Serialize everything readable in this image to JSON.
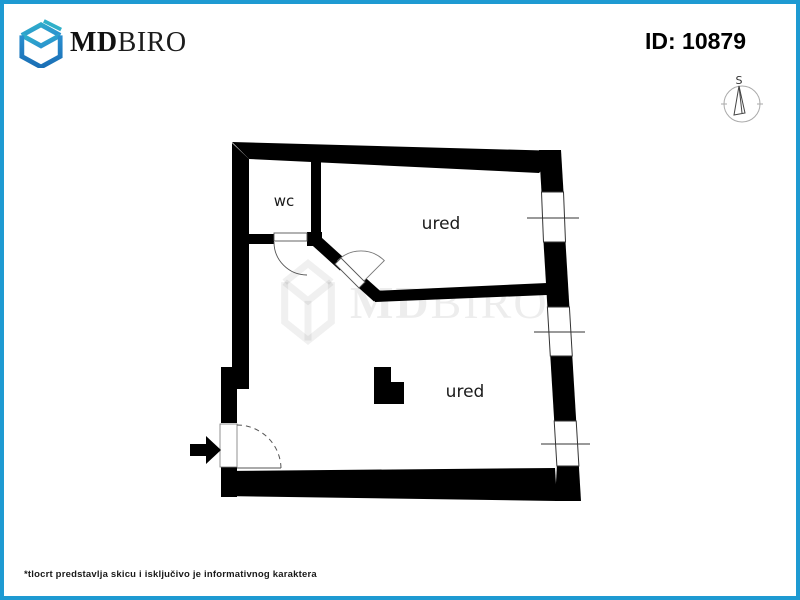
{
  "page": {
    "accent_border_color": "#1e9ad2",
    "wall_color": "#000000",
    "background_color": "#ffffff"
  },
  "header": {
    "logo": {
      "md": "MD",
      "biro": "BIRO",
      "color_top": "#2fb0c9",
      "color_bottom": "#1a6fb5"
    },
    "id_label": "ID: 10879"
  },
  "compass": {
    "north_label": "S"
  },
  "floorplan": {
    "rooms": [
      {
        "name": "wc",
        "label": "wc"
      },
      {
        "name": "ured-upper",
        "label": "ured"
      },
      {
        "name": "ured-lower",
        "label": "ured"
      }
    ]
  },
  "watermark": {
    "md": "MD",
    "biro": "BIRO"
  },
  "footer": {
    "disclaimer": "*tlocrt predstavlja skicu i isključivo je informativnog karaktera"
  }
}
